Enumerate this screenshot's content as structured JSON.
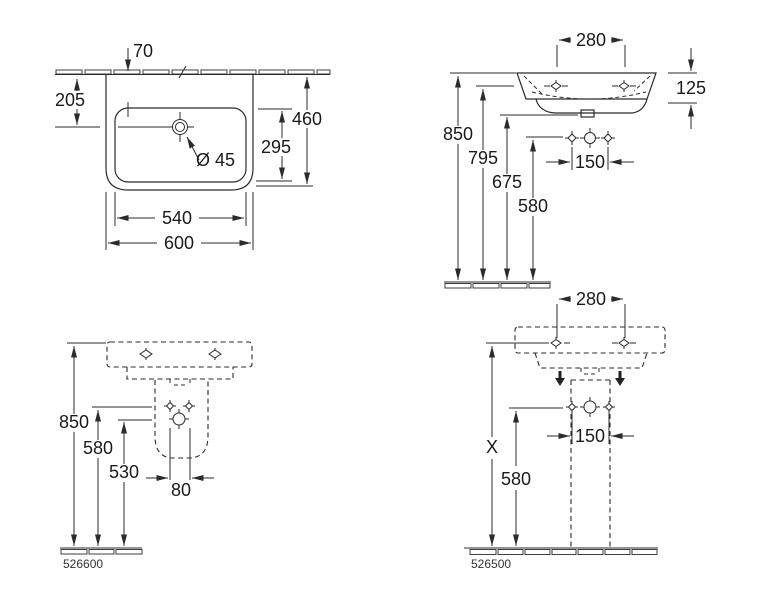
{
  "app": {
    "type": "technical-drawing",
    "subject": "washbasin and pedestal installation dimensions"
  },
  "views": {
    "top_view": {
      "dims": {
        "d70": "70",
        "d205": "205",
        "d460": "460",
        "d295": "295",
        "drain": "Ø 45",
        "d540": "540",
        "d600": "600"
      }
    },
    "front_wall_hung": {
      "dims": {
        "d280": "280",
        "d125": "125",
        "d850": "850",
        "d795": "795",
        "d675": "675",
        "d580": "580",
        "d150": "150"
      }
    },
    "side_pedestal": {
      "dims": {
        "d850": "850",
        "d580": "580",
        "d530": "530",
        "d80": "80"
      },
      "product_number": "526600"
    },
    "front_pedestal": {
      "dims": {
        "d280": "280",
        "dX": "X",
        "d580": "580",
        "d150": "150"
      },
      "product_number": "526500"
    }
  },
  "colors": {
    "line": "#2b2b2b",
    "text": "#1a1a1a",
    "background": "#ffffff"
  }
}
